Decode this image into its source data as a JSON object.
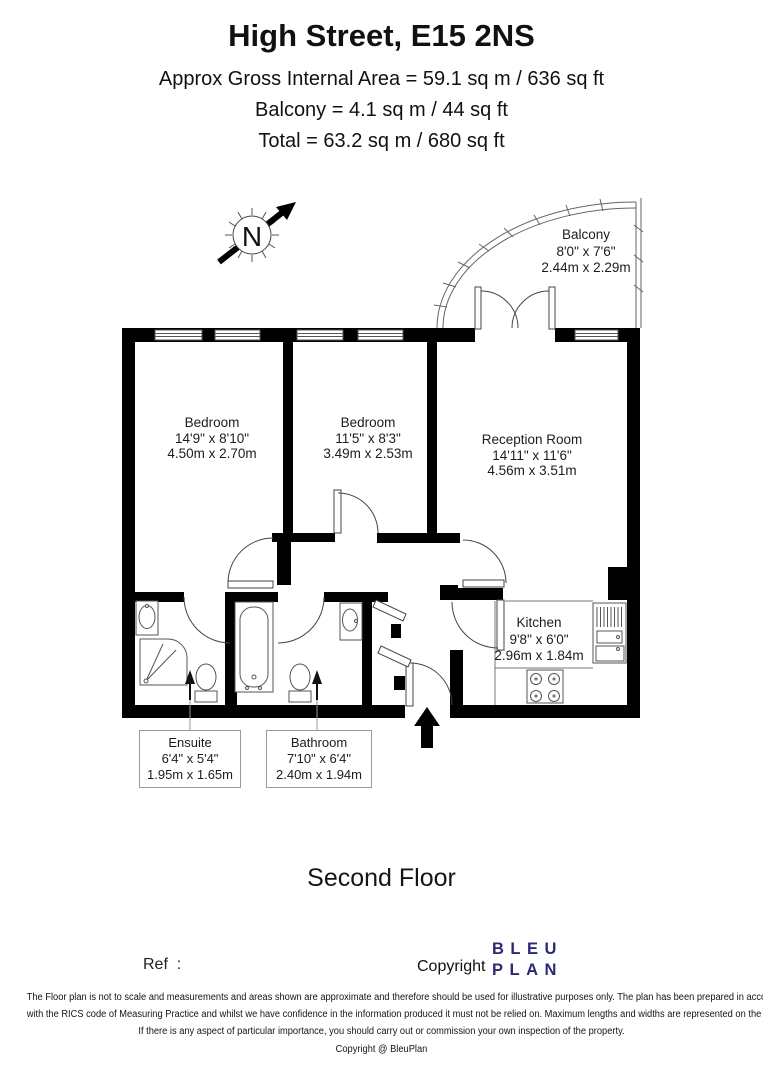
{
  "header": {
    "title": "High Street, E15 2NS",
    "area_line": "Approx Gross Internal Area = 59.1 sq m / 636 sq ft",
    "balcony_line": "Balcony = 4.1 sq m / 44 sq ft",
    "total_line": "Total = 63.2 sq m / 680 sq ft"
  },
  "compass": {
    "label": "N"
  },
  "rooms": {
    "bedroom1": {
      "name": "Bedroom",
      "imperial": "14'9\" x 8'10\"",
      "metric": "4.50m x 2.70m"
    },
    "bedroom2": {
      "name": "Bedroom",
      "imperial": "11'5\" x 8'3\"",
      "metric": "3.49m x 2.53m"
    },
    "reception": {
      "name": "Reception Room",
      "imperial": "14'11\" x 11'6\"",
      "metric": "4.56m x 3.51m"
    },
    "kitchen": {
      "name": "Kitchen",
      "imperial": "9'8\" x 6'0\"",
      "metric": "2.96m x 1.84m"
    },
    "balcony": {
      "name": "Balcony",
      "imperial": "8'0\" x 7'6\"",
      "metric": "2.44m x 2.29m"
    },
    "ensuite": {
      "name": "Ensuite",
      "imperial": "6'4\" x 5'4\"",
      "metric": "1.95m x 1.65m"
    },
    "bathroom": {
      "name": "Bathroom",
      "imperial": "7'10\" x 6'4\"",
      "metric": "2.40m x 1.94m"
    }
  },
  "floor_label": "Second Floor",
  "footer": {
    "ref_label": "Ref  :",
    "copyright_label": "Copyright",
    "logo_line1": "BLEU",
    "logo_line2": "PLAN",
    "logo_color": "#2b2a72"
  },
  "disclaimer": {
    "line1": "The Floor plan is not to scale and measurements and areas shown are approximate and therefore should be used for illustrative purposes only. The plan has been prepared in accordance",
    "line2": "with the RICS code of Measuring Practice and whilst we have confidence in the information produced it must not be relied on. Maximum lengths and widths are represented on the floor plan.",
    "line3": "If there is any aspect of particular importance, you should carry out or commission your own inspection of the property.",
    "line4": "Copyright @ BleuPlan"
  }
}
